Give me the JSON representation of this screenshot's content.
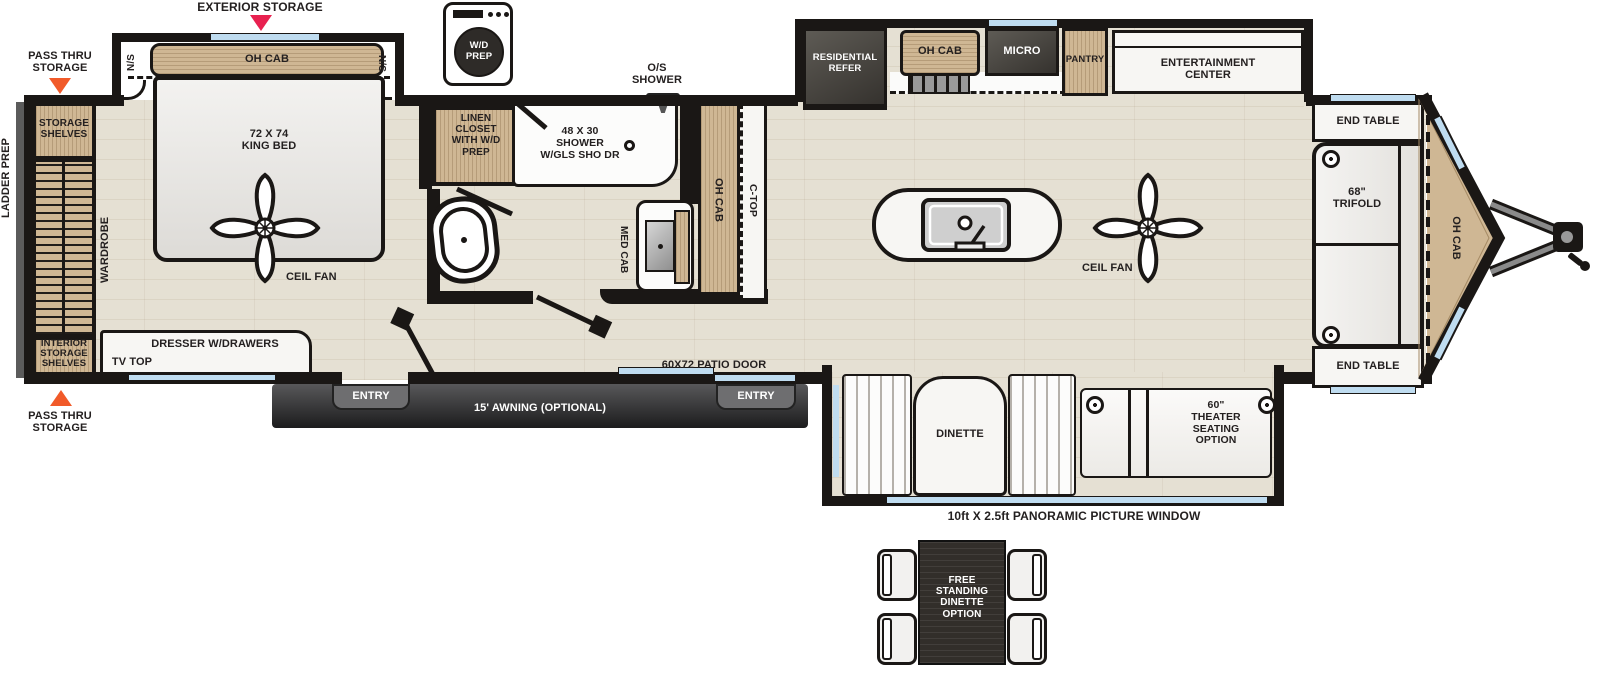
{
  "title": "Travel trailer floor plan",
  "colors": {
    "accent_red": "#E82150",
    "accent_orange": "#F15A29",
    "window_blue": "#BFDCF0",
    "wood": "#CFB794",
    "appliance_dark": "#3A3733",
    "wall_black": "#1A1715"
  },
  "callouts": {
    "exterior_storage": "EXTERIOR STORAGE",
    "pass_thru_top": "PASS THRU\nSTORAGE",
    "pass_thru_bottom": "PASS THRU\nSTORAGE",
    "ladder_prep": "LADDER PREP",
    "wd_prep": "W/D\nPREP",
    "os_shower": "O/S\nSHOWER",
    "patio_door": "60X72 PATIO DOOR",
    "entry_left": "ENTRY",
    "entry_right": "ENTRY",
    "awning": "15' AWNING (OPTIONAL)",
    "panoramic_window": "10ft X 2.5ft PANORAMIC PICTURE WINDOW"
  },
  "bedroom": {
    "slide_oh_cab": "OH CAB",
    "ns_left": "N/S",
    "ns_right": "N/S",
    "king_bed": "72 X 74\nKING BED",
    "ceil_fan": "CEIL FAN",
    "wardrobe": "WARDROBE",
    "storage_shelves": "STORAGE\nSHELVES",
    "interior_storage_shelves": "INTERIOR\nSTORAGE\nSHELVES",
    "dresser": "DRESSER W/DRAWERS",
    "tv_top": "TV TOP"
  },
  "bathroom": {
    "linen_closet": "LINEN\nCLOSET\nWITH W/D\nPREP",
    "shower": "48 X 30\nSHOWER\nW/GLS SHO DR",
    "med_cab": "MED CAB",
    "oh_cab": "OH CAB",
    "c_top": "C-TOP"
  },
  "kitchen": {
    "residential_refer": "RESIDENTIAL\nREFER",
    "oh_cab": "OH CAB",
    "micro": "MICRO",
    "pantry": "PANTRY",
    "entertainment_center": "ENTERTAINMENT\nCENTER",
    "ceil_fan": "CEIL FAN"
  },
  "front": {
    "end_table_top": "END TABLE",
    "end_table_bottom": "END TABLE",
    "trifold": "68\"\nTRIFOLD",
    "oh_cab": "OH CAB"
  },
  "rear_slide": {
    "dinette": "DINETTE",
    "theater": "60\"\nTHEATER\nSEATING\nOPTION"
  },
  "options": {
    "free_standing_dinette": "FREE\nSTANDING\nDINETTE\nOPTION"
  }
}
